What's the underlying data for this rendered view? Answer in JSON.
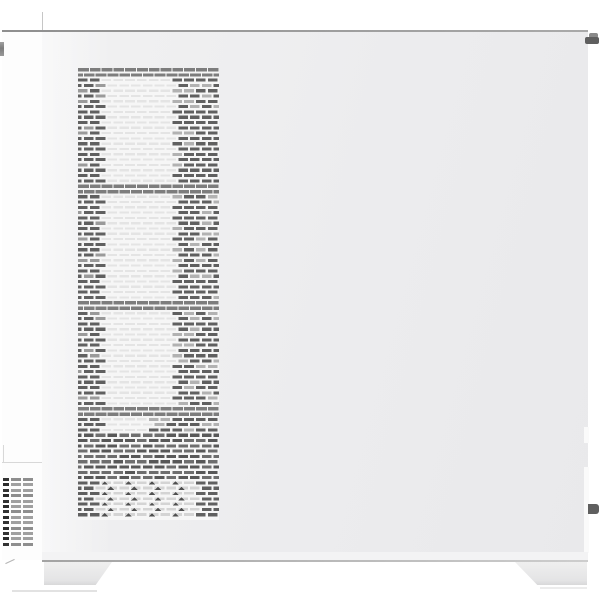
{
  "photo": {
    "subject": "white mid-tower PC computer case, side view with front ventilation mesh",
    "background": "#ffffff",
    "width": 600,
    "height": 600
  },
  "colors": {
    "panel_a": "#f1f1f2",
    "panel_b": "#ececee",
    "panel_c": "#e9e9eb",
    "front_strip": "#fdfdfd",
    "top_edge_a": "#8f8f8f",
    "top_edge_b": "#a9a9a9",
    "bottom_edge_a": "#a3a3a3",
    "bottom_edge_b": "#cdcdcd",
    "seam": "#d8d8d8",
    "foot_a": "#efefef",
    "foot_b": "#e4e4e5",
    "foot_c": "#d8d8d9",
    "shadow": "#e2e2e2",
    "knob": "#7d7d7d",
    "screw_dark": "#5f5f5f",
    "screw_mid": "#8a8a8a",
    "mesh_base": "#f6f6f6",
    "mesh_dark": "#606060",
    "mesh_dark_alt": "#6e6e6e",
    "mesh_gap_light": "#b2b2b2",
    "mesh_mid_light": "#e4e4e4",
    "mesh_band": "#7d7d7d",
    "mesh_tri_mark": "#4f4f4f",
    "mesh_tri_light": "#d4d4d4",
    "grille_dark": "#333333",
    "grille_light": "#a0a0a0",
    "notch": "#fafafa"
  },
  "case": {
    "body": {
      "x": 42,
      "y": 32,
      "w": 546,
      "h": 528
    },
    "top_edge": {
      "x": 2,
      "y": 30,
      "w": 586,
      "h": 2
    },
    "top_seam": {
      "x": 42,
      "y": 12,
      "w": 1,
      "h": 18,
      "color": "#c6c6c6"
    },
    "bottom_strip": {
      "x": 42,
      "y": 552,
      "w": 546,
      "h": 8,
      "color": "#f3f3f4"
    },
    "bottom_edge": {
      "x": 42,
      "y": 560,
      "w": 546,
      "h": 2
    },
    "front_strip": {
      "x": 2,
      "y": 32,
      "w": 40,
      "h": 528
    },
    "front_seam_h": {
      "x": 2,
      "y": 462,
      "w": 40,
      "h": 1
    },
    "front_seam_v": {
      "x": 3,
      "y": 445,
      "w": 1,
      "h": 17
    },
    "front_knob": {
      "x": 0,
      "y": 42,
      "w": 4,
      "h": 14
    },
    "front_bottom_tick": {
      "x": 5,
      "y": 561,
      "w": 10,
      "h": 1,
      "angle": -25,
      "color": "#b5b5b5"
    },
    "right_notches": [
      {
        "x": 584,
        "y": 427,
        "w": 5,
        "h": 16
      },
      {
        "x": 584,
        "y": 467,
        "w": 5,
        "h": 86
      }
    ]
  },
  "mesh": {
    "x": 78,
    "y": 68,
    "w": 141,
    "h": 452,
    "row_pitch": 5.3,
    "dash_h": 3.1,
    "slot_pitch": 11.8,
    "dash_w": 9.6,
    "left_col_end": 101,
    "mid_end": 173,
    "bands_y": [
      [
        68,
        76
      ],
      [
        184,
        192
      ],
      [
        301,
        309
      ],
      [
        340,
        348
      ]
    ],
    "bands_abs": [
      [
        68,
        76
      ],
      [
        184,
        192
      ],
      [
        301,
        309
      ],
      [
        408,
        416
      ]
    ],
    "solid_zone": [
      434,
      478
    ],
    "tri_zone": [
      478,
      520
    ],
    "narrow_zone": {
      "from": 416,
      "to": 434,
      "mid_end": 150
    }
  },
  "grille": {
    "x": 3,
    "y": 478,
    "rows": 13,
    "row_pitch": 5.4,
    "dash_h": 3,
    "cols": [
      {
        "dx": 0,
        "w": 6,
        "tone": "dark"
      },
      {
        "dx": 8,
        "w": 10,
        "tone": "light"
      },
      {
        "dx": 20,
        "w": 10,
        "tone": "light"
      }
    ]
  },
  "feet": {
    "left": {
      "x": 44,
      "y": 562,
      "w": 68,
      "h": 23,
      "clip": "polygon(0 0, 100% 0, 76% 100%, 0 100%)"
    },
    "right": {
      "x": 515,
      "y": 562,
      "w": 72,
      "h": 23,
      "clip": "polygon(0 0, 100% 0, 100% 100%, 31% 100%)"
    },
    "shadow_left": {
      "x": 12,
      "y": 590,
      "w": 85,
      "h": 2
    },
    "shadow_right": {
      "x": 540,
      "y": 587,
      "w": 47,
      "h": 2,
      "color": "#ececec"
    }
  },
  "screws": {
    "top": {
      "x": 585,
      "y": 32,
      "w": 14,
      "h": 14
    },
    "bottom": {
      "x": 588,
      "y": 504,
      "w": 11,
      "h": 10
    }
  }
}
